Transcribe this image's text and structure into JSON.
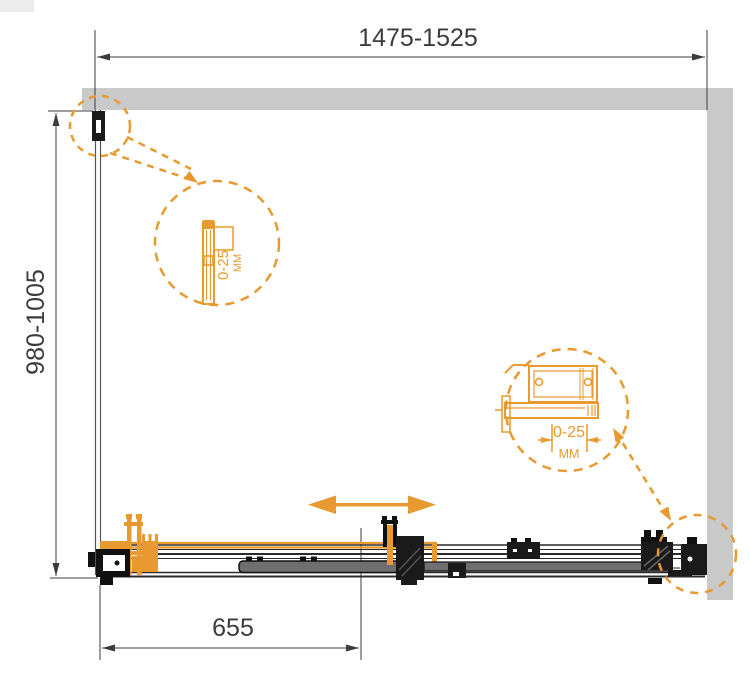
{
  "drawing": {
    "width_label": "1475-1525",
    "height_label": "980-1005",
    "offset_label": "655",
    "detail_left": {
      "range": "0-25",
      "unit": "ММ"
    },
    "detail_right": {
      "range": "0-25",
      "unit": "ММ"
    },
    "colors": {
      "accent_orange": "#E8992F",
      "wall_gray": "#C9C9C9",
      "line_dark": "#2B2B2B",
      "text_gray": "#3C3C3C",
      "panel_gray": "#6F6F6F"
    }
  }
}
